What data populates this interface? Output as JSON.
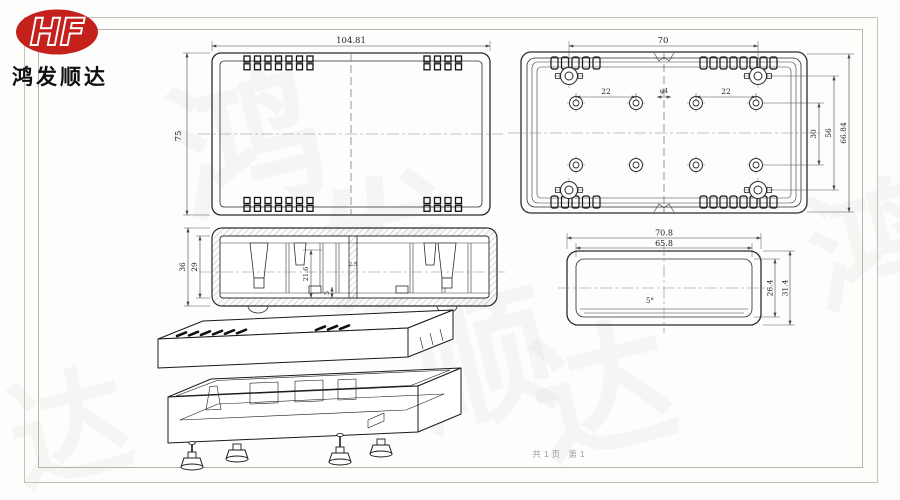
{
  "brand": {
    "initials": "HF",
    "company_name": "鸿发顺达",
    "logo_color": "#c5211c"
  },
  "watermark": {
    "text": "鸿发顺达",
    "chars": [
      "鸿",
      "发",
      "顺",
      "达"
    ]
  },
  "footer": {
    "page_info": "共1页 第1"
  },
  "colors": {
    "line": "#2b2b2b",
    "dimension": "#444444",
    "border": "#c9c6c1",
    "logo_red": "#c5211c"
  },
  "views": {
    "top": {
      "name": "cover-top-view",
      "dim_width": "104.81",
      "dim_height": "75"
    },
    "base": {
      "name": "base-interior-view",
      "dim_boss_span": "70",
      "dim_pitch_left": "22",
      "dim_pitch_right": "22",
      "dim_center_hole": "φ4",
      "dim_row_pitch": "30",
      "dim_mid_span": "56",
      "dim_total": "66.84"
    },
    "section": {
      "name": "assembly-section-view",
      "dim_outer_height": "36",
      "dim_inner_height": "29",
      "dim_cavity": "21.6",
      "dim_foot": "5",
      "dim_rib": "2.5"
    },
    "end": {
      "name": "end-view",
      "dim_outer_width": "70.8",
      "dim_inner_width": "65.8",
      "dim_inner_height": "26.4",
      "dim_outer_height": "31.4",
      "draft_angle": "5°"
    },
    "iso": {
      "name": "exploded-isometric-view"
    }
  }
}
